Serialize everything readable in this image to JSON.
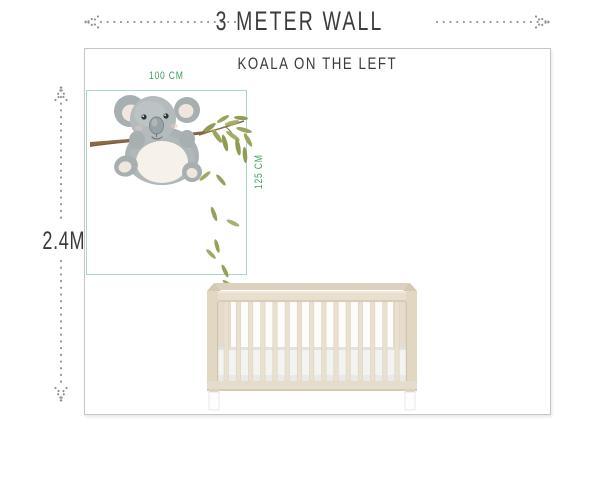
{
  "header": {
    "title": "3 METER WALL"
  },
  "wall": {
    "heading": "KOALA ON THE LEFT",
    "height_label": "2.4M"
  },
  "decal": {
    "width_label": "100 CM",
    "height_label": "125 CM"
  },
  "illustrations": {
    "decal_icon": "koala-on-branch",
    "furniture_icon": "baby-crib"
  },
  "colors": {
    "measure_green": "#3da05f",
    "decal_box_teal": "#a6d9c4",
    "arrow_gray": "#8f8f8f",
    "text_dark": "#3b3b3b",
    "wall_border": "#c6c6c6",
    "crib_wood": "#e8dfce",
    "leaf_green": "#8f9c52",
    "koala_gray": "#aeb6b7"
  }
}
